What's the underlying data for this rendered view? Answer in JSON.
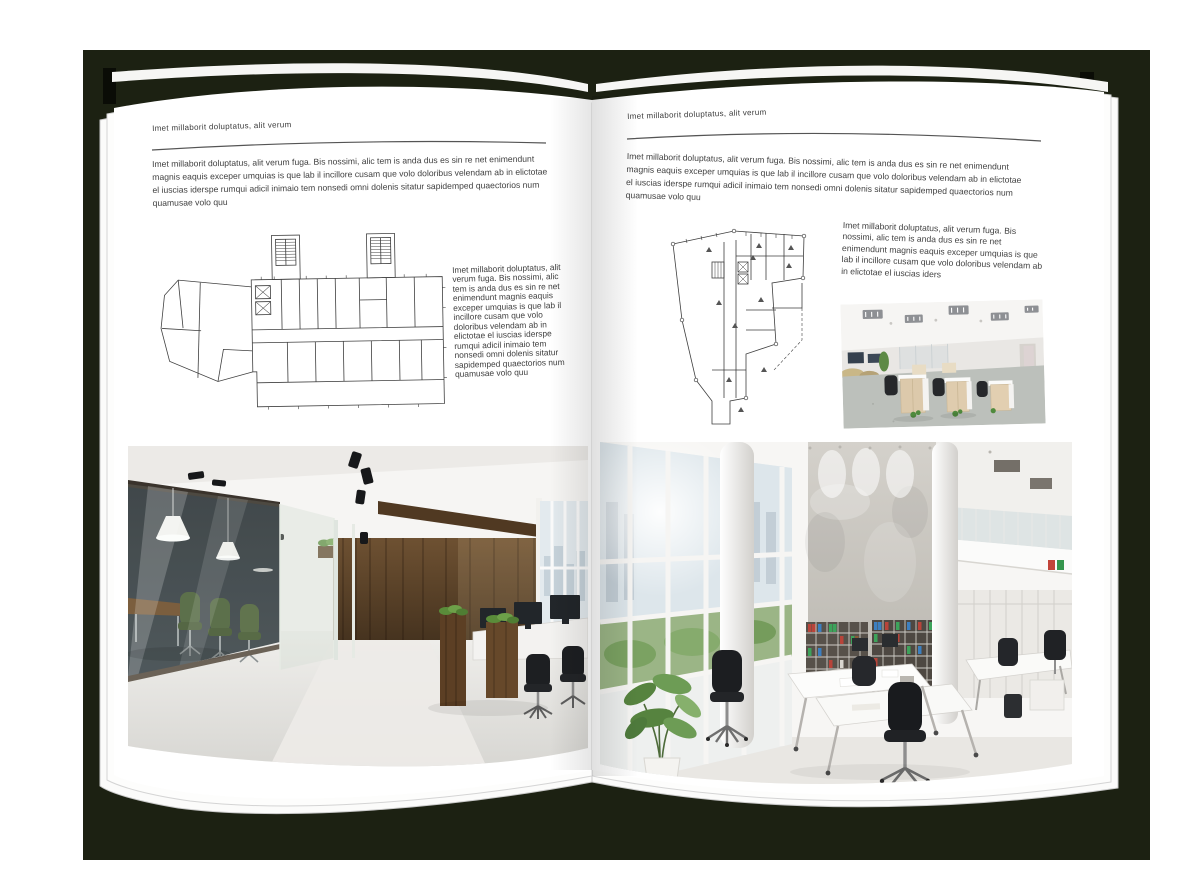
{
  "colors": {
    "backdrop": "#1c2112",
    "page": "#ffffff",
    "text": "#404040"
  },
  "left_page": {
    "header": "Imet millaborit doluptatus, alit verum",
    "intro": "Imet millaborit doluptatus, alit verum fuga. Bis nossimi, alic tem is anda dus es sin re net enimendunt magnis eaquis exceper umquias is que lab il incillore cusam que volo doloribus velendam ab in elictotae el iuscias iderspe rumqui adicil inimaio tem nonsedi omni dolenis sitatur sapidemped quaectorios num quamusae volo quu",
    "plan_caption": "Imet millaborit doluptatus, alit verum fuga. Bis nossimi, alic tem is anda dus es sin re net enimendunt magnis eaquis exceper umquias is que lab il incillore cusam que volo doloribus velendam ab in elictotae el iuscias iderspe rumqui adicil inimaio tem nonsedi omni dolenis sitatur sapidemped quaectorios num quamusae volo quu"
  },
  "right_page": {
    "header": "Imet millaborit doluptatus, alit verum",
    "intro": "Imet millaborit doluptatus, alit verum fuga. Bis nossimi, alic tem is anda dus es sin re net enimendunt magnis eaquis exceper umquias is que lab il incillore cusam que volo doloribus velendam ab in elictotae el iuscias iderspe rumqui adicil inimaio tem nonsedi omni dolenis sitatur sapidemped quaectorios num quamusae volo quu",
    "plan_caption": "Imet millaborit doluptatus, alit verum fuga. Bis nossimi, alic tem is anda dus es sin re net enimendunt magnis eaquis exceper umquias is que lab il incillore cusam que volo doloribus velendam ab in elictotae el iuscias iders"
  }
}
